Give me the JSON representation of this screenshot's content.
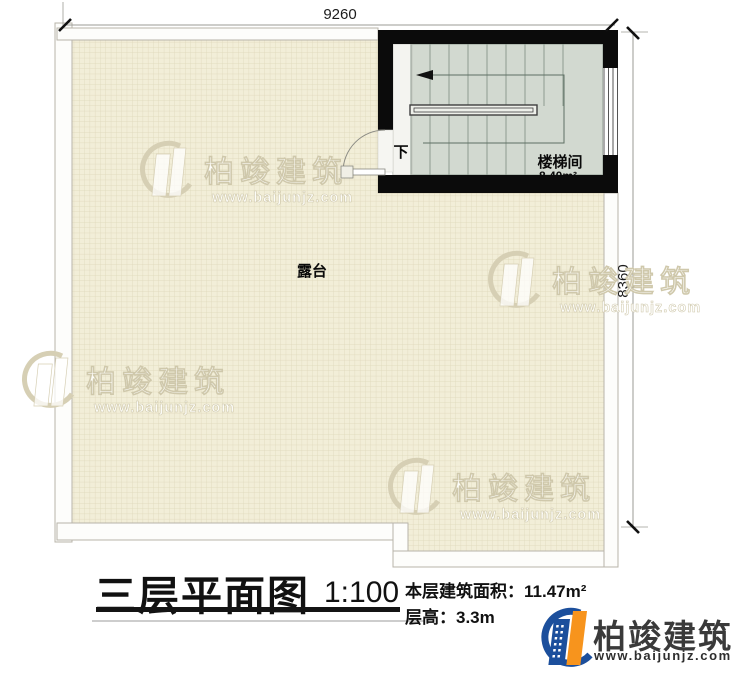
{
  "plan": {
    "dimensions": {
      "width_mm": "9260",
      "height_mm": "8360"
    },
    "terrace": {
      "label": "露台"
    },
    "stairwell": {
      "label": "楼梯间",
      "area": "8.40m²",
      "down_label": "下"
    }
  },
  "title_block": {
    "title": "三层平面图",
    "scale": "1:100",
    "floor_area_label": "本层建筑面积：",
    "floor_area_value": "11.47m²",
    "floor_height_label": "层高：",
    "floor_height_value": "3.3m"
  },
  "branding": {
    "company": "柏竣建筑",
    "website": "www.baijunjz.com",
    "logo_blue": "#1c4f9c",
    "logo_orange": "#f7941d"
  },
  "colors": {
    "floor_fill": "#f2eed8",
    "floor_grid": "#ddd6b9",
    "stair_floor": "#d2d9d0",
    "wall": "#0b0b0b"
  }
}
